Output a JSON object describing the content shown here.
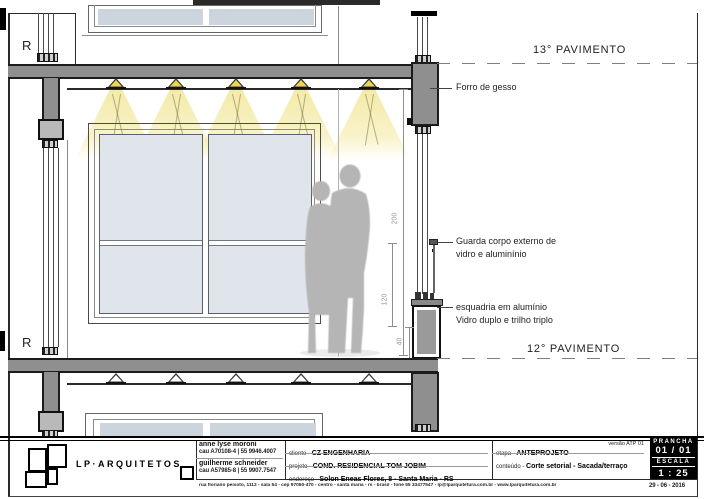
{
  "drawing": {
    "levels": {
      "upper": "13° PAVIMENTO",
      "lower": "12° PAVIMENTO"
    },
    "annotations": {
      "forro": "Forro de gesso",
      "guarda_line1": "Guarda corpo externo de",
      "guarda_line2": "vidro e aluminínio",
      "esquadria_line1": "esquadria em alumínio",
      "esquadria_line2": "Vidro duplo e trilho triplo",
      "edge_text": "R"
    },
    "dimensions": {
      "total": "200",
      "rail": "120",
      "parapet": "40"
    }
  },
  "titleblock": {
    "firm": "LP·ARQUITETOS",
    "architects": [
      {
        "name": "anne lyse moroni",
        "registration": "cau A70108-4 |  55  9946.4007"
      },
      {
        "name": "guilherme schneider",
        "registration": "cau A57985-8 |  55  9907.7547"
      }
    ],
    "fields": [
      {
        "label": "cliente",
        "value": "CZ ENGENHARIA"
      },
      {
        "label": "projeto",
        "value": "COND. RESIDENCIAL TOM JOBIM"
      },
      {
        "label": "endereço",
        "value": "Solon Eneas Flores, 8  -  Santa Maria  -  RS"
      }
    ],
    "stage": {
      "label": "etapa",
      "value": "ANTEPROJETO",
      "version": "versão ATP 01",
      "content_label": "conteúdo",
      "content": "Corte setorial - Sacada/terraço"
    },
    "sheet": {
      "prancha_label": "PRANCHA",
      "prancha": "01 / 01",
      "escala_label": "ESCALA",
      "escala": "1 : 25",
      "date": "29 - 06 - 2016"
    },
    "address": "rua floriano peixoto, 1112 - sala 54 - cep 97050-470 - centro - santa maria - rs - brasil     -     fone  55 33477547     -     lp@lparquitetura.com.br     -     www.lparquitetura.com.br"
  },
  "colors": {
    "slab_gray": "#8f8f8f",
    "box_gray": "#b9b9b9",
    "glass": "#dfe4ec",
    "light_cone": "#f2e9a6",
    "fixture_yellow": "#e8d24a",
    "silhouette": "#b5b5b5"
  }
}
